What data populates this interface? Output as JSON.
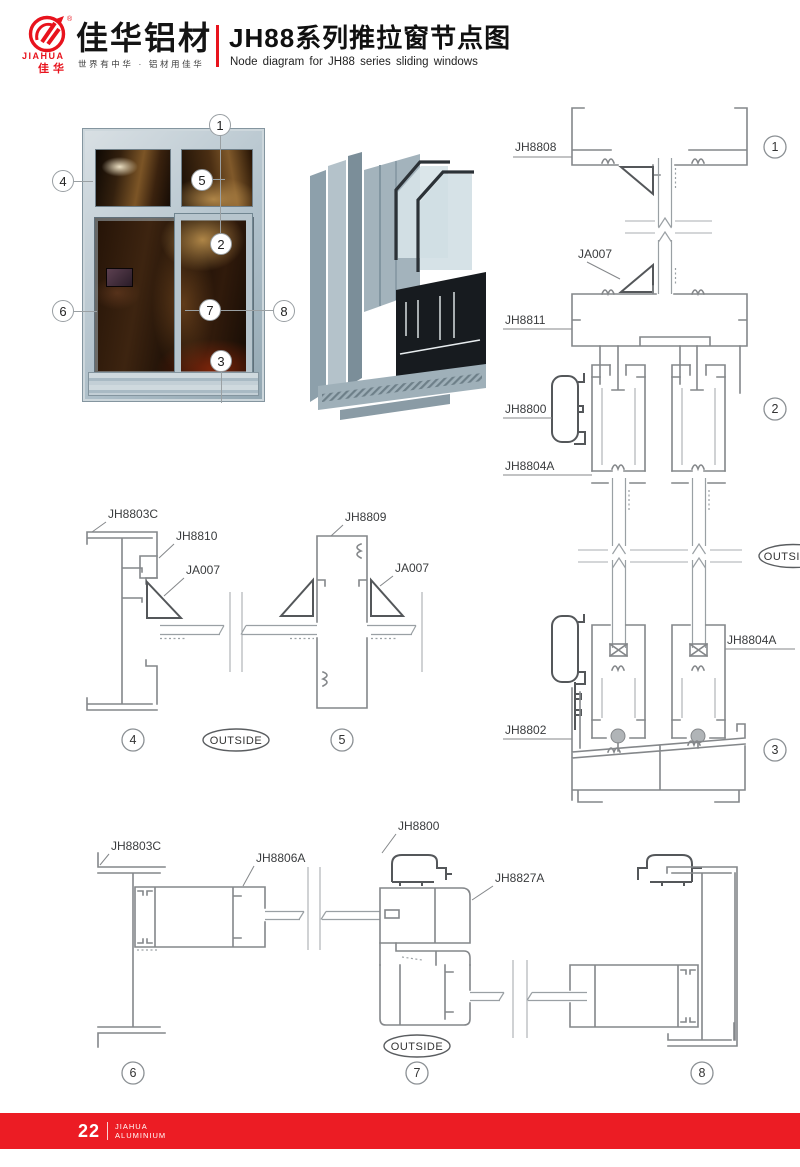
{
  "header": {
    "logo": {
      "brand_en": "JIAHUA",
      "brand_cn": "佳华",
      "registered": "®"
    },
    "brand_name": "佳华铝材",
    "slogan": "世界有中华 · 铝材用佳华",
    "title_cn": "JH88系列推拉窗节点图",
    "title_en": "Node diagram for JH88 series sliding windows"
  },
  "window_figure": {
    "callouts": {
      "c1": "1",
      "c2": "2",
      "c3": "3",
      "c4": "4",
      "c5": "5",
      "c6": "6",
      "c7": "7",
      "c8": "8"
    }
  },
  "diagrams": {
    "right": {
      "jh8808": "JH8808",
      "ja007": "JA007",
      "jh8811": "JH8811",
      "jh8800": "JH8800",
      "jh8804a_top": "JH8804A",
      "jh8804a_bottom": "JH8804A",
      "jh8802": "JH8802",
      "outside": "OUTSIDE",
      "c1": "1",
      "c2": "2",
      "c3": "3"
    },
    "middle": {
      "jh8803c": "JH8803C",
      "jh8810": "JH8810",
      "ja007_left": "JA007",
      "jh8809": "JH8809",
      "ja007_right": "JA007",
      "outside": "OUTSIDE",
      "c4": "4",
      "c5": "5"
    },
    "bottom": {
      "jh8803c": "JH8803C",
      "jh8806a": "JH8806A",
      "jh8800": "JH8800",
      "jh8827a": "JH8827A",
      "outside": "OUTSIDE",
      "c6": "6",
      "c7": "7",
      "c8": "8"
    }
  },
  "footer": {
    "page_number": "22",
    "brand_line1": "JIAHUA",
    "brand_line2": "ALUMINIUM"
  },
  "colors": {
    "accent_red": "#e8131d",
    "footer_red": "#ec1c24",
    "line_gray": "#84878a"
  }
}
